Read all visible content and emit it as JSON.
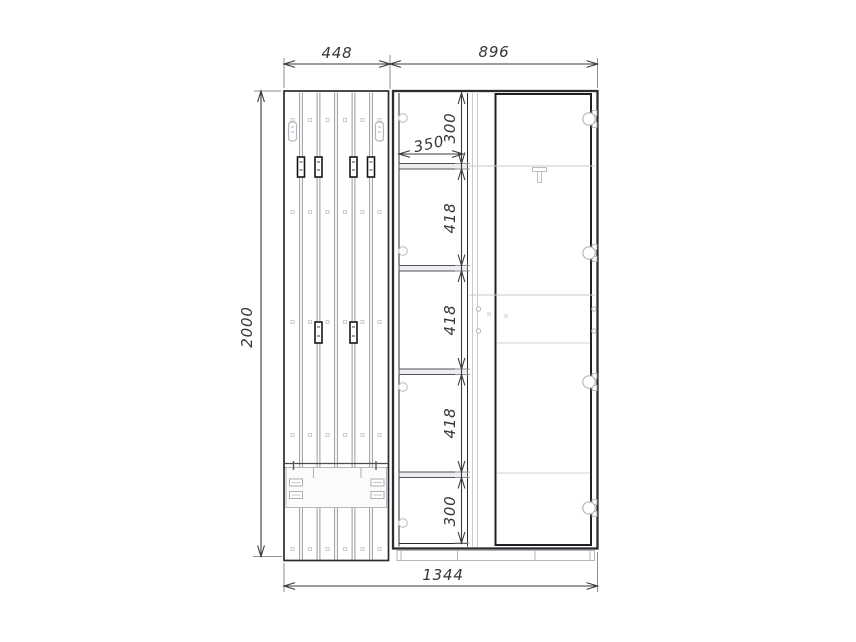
{
  "drawing": {
    "type": "furniture front elevation",
    "components": {
      "left_unit": "slatted coat-rack panel with hooks and bench",
      "right_unit": "wardrobe cabinet with open shelf column and hinged door"
    },
    "colors": {
      "background": "#ffffff",
      "outline_dark": "#2c2c30",
      "line_mid": "#9a9aa0",
      "line_light": "#c6c6cb",
      "dimension_line": "#3a3a40"
    }
  },
  "dimensions": {
    "panel_width": "448",
    "cabinet_width": "896",
    "total_height": "2000",
    "total_width": "1344",
    "shelf_width": "350",
    "compartments": [
      "300",
      "418",
      "418",
      "418",
      "300"
    ]
  }
}
